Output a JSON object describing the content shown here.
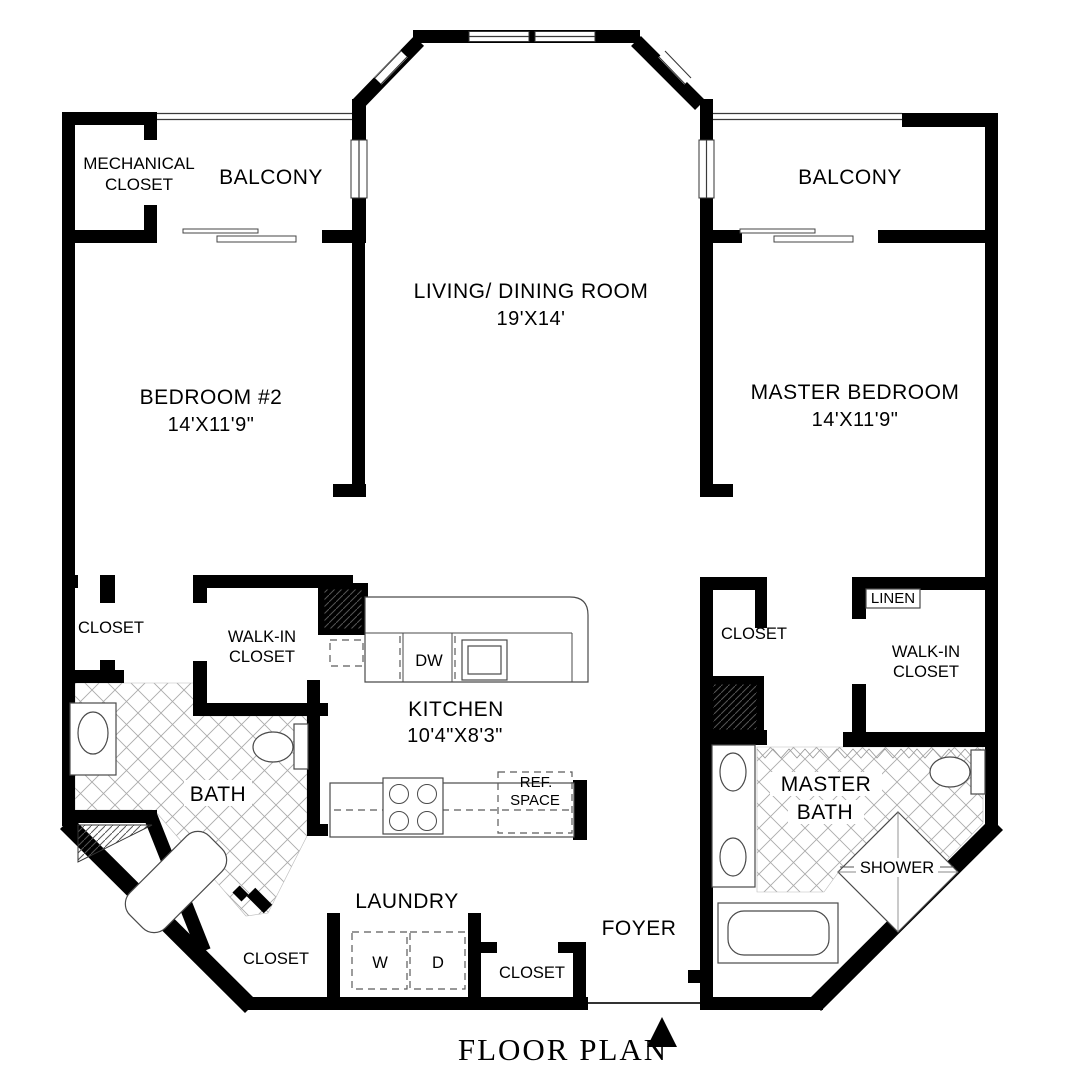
{
  "title": "FLOOR PLAN",
  "rooms": {
    "mechanical_closet": {
      "line1": "MECHANICAL",
      "line2": "CLOSET"
    },
    "balcony_left": {
      "label": "BALCONY"
    },
    "balcony_right": {
      "label": "BALCONY"
    },
    "living_dining": {
      "label": "LIVING/ DINING ROOM",
      "dims": "19'X14'"
    },
    "bedroom_2": {
      "label": "BEDROOM #2",
      "dims": "14'X11'9\""
    },
    "master_bedroom": {
      "label": "MASTER BEDROOM",
      "dims": "14'X11'9\""
    },
    "bedroom_2_closet": {
      "label": "CLOSET"
    },
    "walk_in_closet_left": {
      "line1": "WALK-IN",
      "line2": "CLOSET"
    },
    "linen_closet": {
      "label": "LINEN"
    },
    "master_closet": {
      "label": "CLOSET"
    },
    "walk_in_closet_right": {
      "line1": "WALK-IN",
      "line2": "CLOSET"
    },
    "kitchen": {
      "label": "KITCHEN",
      "dims": "10'4\"X8'3\"",
      "dishwasher": "DW",
      "ref_line1": "REF.",
      "ref_line2": "SPACE"
    },
    "bath": {
      "label": "BATH"
    },
    "master_bath": {
      "line1": "MASTER",
      "line2": "BATH",
      "shower": "SHOWER"
    },
    "laundry": {
      "label": "LAUNDRY",
      "washer": "W",
      "dryer": "D"
    },
    "closet_bottom_left": {
      "label": "CLOSET"
    },
    "closet_bottom_middle": {
      "label": "CLOSET"
    },
    "foyer": {
      "label": "FOYER"
    }
  }
}
